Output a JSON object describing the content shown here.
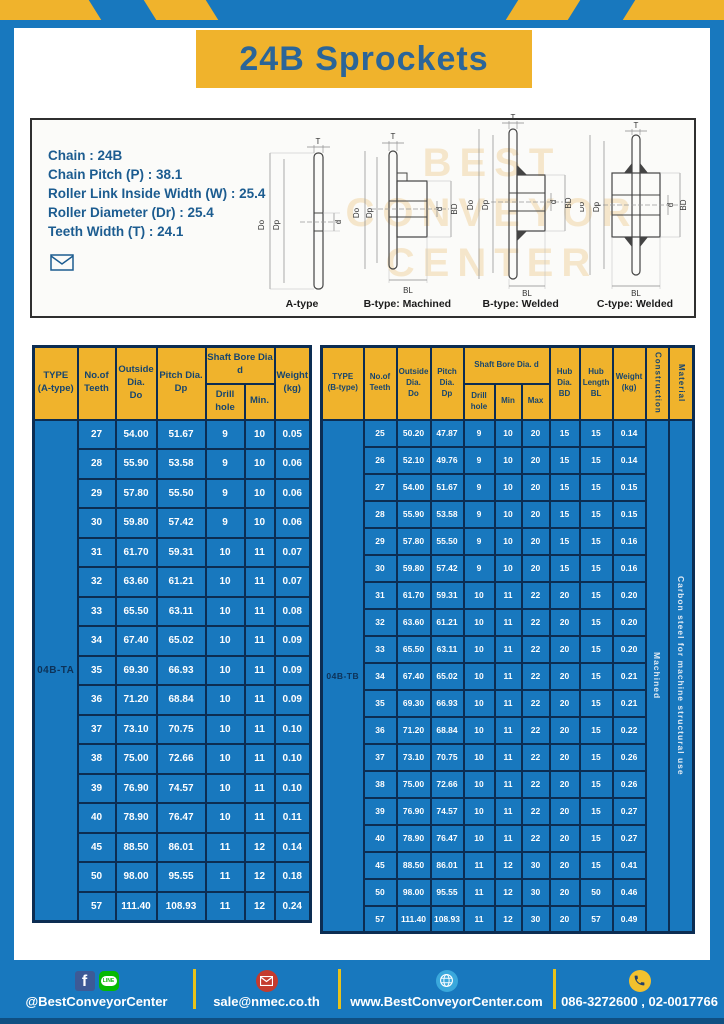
{
  "header": {
    "title": "24B Sprockets"
  },
  "specs": {
    "lines": [
      "Chain : 24B",
      "Chain Pitch (P) : 38.1",
      "Roller Link Inside Width (W) : 25.4",
      "Roller Diameter (Dr) : 25.4",
      "Teeth Width (T) : 24.1"
    ]
  },
  "watermark": {
    "lines": [
      "BEST",
      "CONVEYOR",
      "CENTER"
    ]
  },
  "drawings": {
    "labels": {
      "t": "T",
      "do": "Do",
      "dp": "Dp",
      "d": "d",
      "bd": "BD",
      "bl": "BL"
    },
    "captions": [
      "A-type",
      "B-type: Machined",
      "B-type: Welded",
      "C-type: Welded"
    ]
  },
  "table_a": {
    "headers": {
      "type": "TYPE\n(A-type)",
      "teeth": "No.of\nTeeth",
      "outside": "Outside\nDia.\nDo",
      "pitch": "Pitch Dia.\nDp",
      "shaft": "Shaft Bore Dia d",
      "drill": "Drill hole",
      "min": "Min.",
      "weight": "Weight\n(kg)"
    },
    "type_label": "04B-TA",
    "rows": [
      [
        "27",
        "54.00",
        "51.67",
        "9",
        "10",
        "0.05"
      ],
      [
        "28",
        "55.90",
        "53.58",
        "9",
        "10",
        "0.06"
      ],
      [
        "29",
        "57.80",
        "55.50",
        "9",
        "10",
        "0.06"
      ],
      [
        "30",
        "59.80",
        "57.42",
        "9",
        "10",
        "0.06"
      ],
      [
        "31",
        "61.70",
        "59.31",
        "10",
        "11",
        "0.07"
      ],
      [
        "32",
        "63.60",
        "61.21",
        "10",
        "11",
        "0.07"
      ],
      [
        "33",
        "65.50",
        "63.11",
        "10",
        "11",
        "0.08"
      ],
      [
        "34",
        "67.40",
        "65.02",
        "10",
        "11",
        "0.09"
      ],
      [
        "35",
        "69.30",
        "66.93",
        "10",
        "11",
        "0.09"
      ],
      [
        "36",
        "71.20",
        "68.84",
        "10",
        "11",
        "0.09"
      ],
      [
        "37",
        "73.10",
        "70.75",
        "10",
        "11",
        "0.10"
      ],
      [
        "38",
        "75.00",
        "72.66",
        "10",
        "11",
        "0.10"
      ],
      [
        "39",
        "76.90",
        "74.57",
        "10",
        "11",
        "0.10"
      ],
      [
        "40",
        "78.90",
        "76.47",
        "10",
        "11",
        "0.11"
      ],
      [
        "45",
        "88.50",
        "86.01",
        "11",
        "12",
        "0.14"
      ],
      [
        "50",
        "98.00",
        "95.55",
        "11",
        "12",
        "0.18"
      ],
      [
        "57",
        "111.40",
        "108.93",
        "11",
        "12",
        "0.24"
      ]
    ]
  },
  "table_b": {
    "headers": {
      "type": "TYPE\n(B-type)",
      "teeth": "No.of\nTeeth",
      "outside": "Outside\nDia.\nDo",
      "pitch": "Pitch\nDia.\nDp",
      "shaft": "Shaft Bore Dia. d",
      "drill": "Drill hole",
      "min": "Min",
      "max": "Max",
      "hub_dia": "Hub\nDia.\nBD",
      "hub_len": "Hub\nLength\nBL",
      "weight": "Weight\n(kg)",
      "construction": "Construction",
      "material": "Material"
    },
    "type_label": "04B-TB",
    "construction_value": "Machined",
    "material_value": "Carbon steel for machine structural use",
    "rows": [
      [
        "25",
        "50.20",
        "47.87",
        "9",
        "10",
        "20",
        "15",
        "15",
        "0.14"
      ],
      [
        "26",
        "52.10",
        "49.76",
        "9",
        "10",
        "20",
        "15",
        "15",
        "0.14"
      ],
      [
        "27",
        "54.00",
        "51.67",
        "9",
        "10",
        "20",
        "15",
        "15",
        "0.15"
      ],
      [
        "28",
        "55.90",
        "53.58",
        "9",
        "10",
        "20",
        "15",
        "15",
        "0.15"
      ],
      [
        "29",
        "57.80",
        "55.50",
        "9",
        "10",
        "20",
        "15",
        "15",
        "0.16"
      ],
      [
        "30",
        "59.80",
        "57.42",
        "9",
        "10",
        "20",
        "15",
        "15",
        "0.16"
      ],
      [
        "31",
        "61.70",
        "59.31",
        "10",
        "11",
        "22",
        "20",
        "15",
        "0.20"
      ],
      [
        "32",
        "63.60",
        "61.21",
        "10",
        "11",
        "22",
        "20",
        "15",
        "0.20"
      ],
      [
        "33",
        "65.50",
        "63.11",
        "10",
        "11",
        "22",
        "20",
        "15",
        "0.20"
      ],
      [
        "34",
        "67.40",
        "65.02",
        "10",
        "11",
        "22",
        "20",
        "15",
        "0.21"
      ],
      [
        "35",
        "69.30",
        "66.93",
        "10",
        "11",
        "22",
        "20",
        "15",
        "0.21"
      ],
      [
        "36",
        "71.20",
        "68.84",
        "10",
        "11",
        "22",
        "20",
        "15",
        "0.22"
      ],
      [
        "37",
        "73.10",
        "70.75",
        "10",
        "11",
        "22",
        "20",
        "15",
        "0.26"
      ],
      [
        "38",
        "75.00",
        "72.66",
        "10",
        "11",
        "22",
        "20",
        "15",
        "0.26"
      ],
      [
        "39",
        "76.90",
        "74.57",
        "10",
        "11",
        "22",
        "20",
        "15",
        "0.27"
      ],
      [
        "40",
        "78.90",
        "76.47",
        "10",
        "11",
        "22",
        "20",
        "15",
        "0.27"
      ],
      [
        "45",
        "88.50",
        "86.01",
        "11",
        "12",
        "30",
        "20",
        "15",
        "0.41"
      ],
      [
        "50",
        "98.00",
        "95.55",
        "11",
        "12",
        "30",
        "20",
        "50",
        "0.46"
      ],
      [
        "57",
        "111.40",
        "108.93",
        "11",
        "12",
        "30",
        "20",
        "57",
        "0.49"
      ]
    ]
  },
  "footer": {
    "line_icon_text": "LINE",
    "facebook_letter": "f",
    "items": [
      {
        "label": "@BestConveyorCenter"
      },
      {
        "label": "sale@nmec.co.th"
      },
      {
        "label": "www.BestConveyorCenter.com"
      },
      {
        "label": "086-3272600 , 02-0017766"
      }
    ]
  },
  "colors": {
    "blue": "#1878be",
    "yellow": "#f0b32c",
    "navy_border": "#0c2d52",
    "title_blue": "#2b6598"
  }
}
